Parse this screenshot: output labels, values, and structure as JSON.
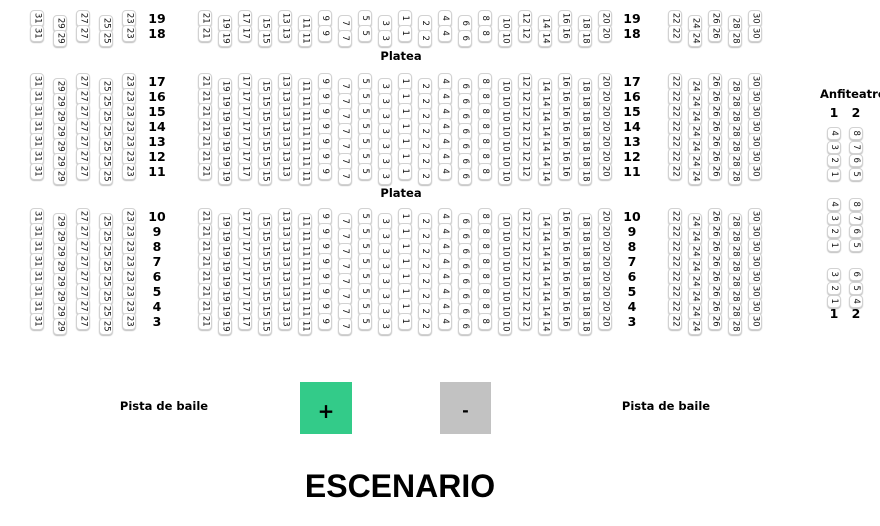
{
  "platea": {
    "label": "Platea"
  },
  "stage": {
    "label": "ESCENARIO"
  },
  "dance_floor": {
    "left_label": "Pista de baile",
    "right_label": "Pista de baile"
  },
  "controls": {
    "zoom_in_label": "+",
    "zoom_out_label": "-",
    "zoom_in_color": "#33cb89",
    "zoom_out_color": "#c2c2c2"
  },
  "seating": {
    "row_groups": [
      {
        "rows": [
          "19",
          "18"
        ],
        "platea_after": true
      },
      {
        "rows": [
          "17",
          "16",
          "15",
          "14",
          "13",
          "12",
          "11"
        ],
        "platea_after": true
      },
      {
        "rows": [
          "10",
          "9",
          "8",
          "7",
          "6",
          "5",
          "4",
          "3"
        ],
        "platea_after": false
      }
    ],
    "left_block_columns": [
      "31",
      "29",
      "27",
      "25",
      "23"
    ],
    "center_block_columns": [
      "21",
      "19",
      "17",
      "15",
      "13",
      "11",
      "9",
      "7",
      "5",
      "3",
      "1",
      "2",
      "4",
      "6",
      "8",
      "10",
      "12",
      "14",
      "16",
      "18",
      "20"
    ],
    "right_block_columns": [
      "22",
      "24",
      "26",
      "28",
      "30"
    ]
  },
  "anfiteatro": {
    "title": "Anfiteatro",
    "column_headers": [
      "1",
      "2"
    ],
    "groups": [
      {
        "column1_top_to_bottom": [
          "4",
          "3",
          "2",
          "1"
        ],
        "column2_top_to_bottom": [
          "8",
          "7",
          "6",
          "5"
        ]
      },
      {
        "column1_top_to_bottom": [
          "4",
          "3",
          "2",
          "1"
        ],
        "column2_top_to_bottom": [
          "8",
          "7",
          "6",
          "5"
        ]
      },
      {
        "column1_top_to_bottom": [
          "3",
          "2",
          "1"
        ],
        "column2_top_to_bottom": [
          "6",
          "5",
          "4"
        ]
      }
    ],
    "bottom_labels": [
      "1",
      "2"
    ]
  }
}
